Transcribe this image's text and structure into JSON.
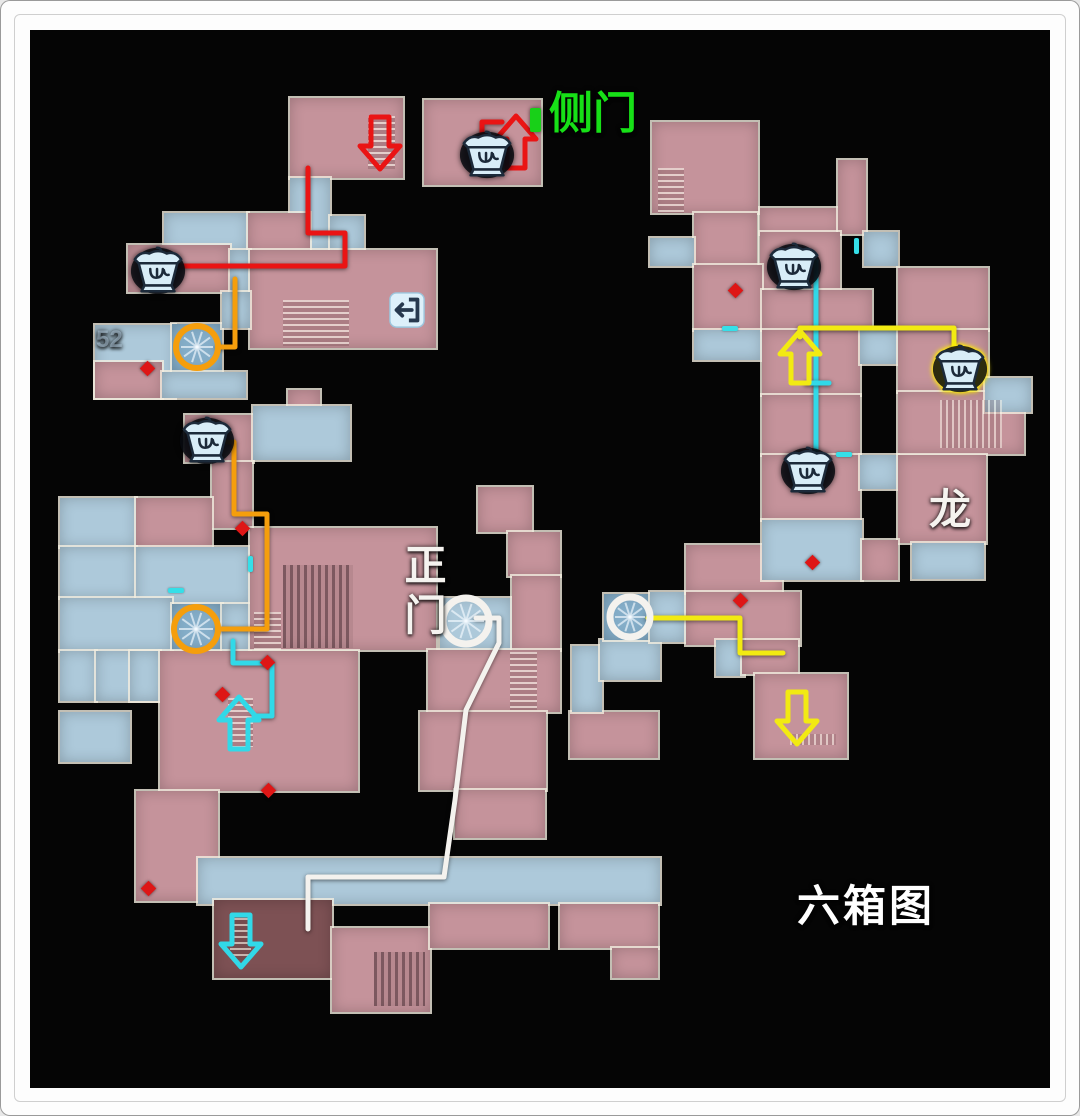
{
  "labels": {
    "side_door": "侧门",
    "main_gate": "正门",
    "dragon": "龙",
    "six_box": "六箱图",
    "room52": "52"
  },
  "palette": {
    "room": {
      "p": "#c5939b",
      "b": "#adc9da",
      "t": "#84adc8",
      "d": "#7d5154"
    },
    "route": {
      "red": "#ea1414",
      "orange": "#f59e0c",
      "cyan": "#31d9e8",
      "yellow": "#f2ea12",
      "white": "#f4f2ee"
    },
    "diamond": "#de1616",
    "tick": "#35dfe8",
    "green_door": "#18d018",
    "label_green": "#17e017",
    "label_white": "#f5f3ef"
  },
  "map": {
    "rooms": [
      [
        290,
        98,
        113,
        80,
        "p"
      ],
      [
        424,
        100,
        117,
        85,
        "p"
      ],
      [
        290,
        178,
        40,
        74,
        "b"
      ],
      [
        330,
        216,
        34,
        36,
        "b"
      ],
      [
        164,
        213,
        84,
        39,
        "b"
      ],
      [
        248,
        213,
        62,
        39,
        "p"
      ],
      [
        128,
        245,
        102,
        47,
        "p"
      ],
      [
        230,
        250,
        20,
        44,
        "b"
      ],
      [
        250,
        250,
        186,
        98,
        "p"
      ],
      [
        95,
        325,
        80,
        73,
        "b"
      ],
      [
        172,
        324,
        50,
        48,
        "t"
      ],
      [
        222,
        292,
        28,
        36,
        "b"
      ],
      [
        95,
        362,
        67,
        36,
        "p"
      ],
      [
        162,
        372,
        84,
        26,
        "b"
      ],
      [
        288,
        390,
        32,
        28,
        "p"
      ],
      [
        185,
        415,
        68,
        47,
        "p"
      ],
      [
        253,
        406,
        97,
        54,
        "b"
      ],
      [
        212,
        462,
        40,
        66,
        "p"
      ],
      [
        60,
        498,
        76,
        49,
        "b"
      ],
      [
        136,
        498,
        76,
        49,
        "p"
      ],
      [
        60,
        547,
        76,
        51,
        "b"
      ],
      [
        136,
        547,
        114,
        58,
        "b"
      ],
      [
        60,
        598,
        112,
        53,
        "b"
      ],
      [
        172,
        604,
        50,
        46,
        "t"
      ],
      [
        60,
        651,
        36,
        50,
        "b"
      ],
      [
        96,
        651,
        64,
        50,
        "b"
      ],
      [
        130,
        651,
        30,
        50,
        "b"
      ],
      [
        222,
        604,
        28,
        47,
        "b"
      ],
      [
        250,
        528,
        186,
        122,
        "p"
      ],
      [
        160,
        651,
        198,
        140,
        "p"
      ],
      [
        60,
        712,
        70,
        50,
        "b"
      ],
      [
        136,
        791,
        82,
        110,
        "p"
      ],
      [
        198,
        858,
        462,
        46,
        "b"
      ],
      [
        214,
        900,
        118,
        78,
        "d"
      ],
      [
        332,
        928,
        98,
        84,
        "p"
      ],
      [
        430,
        904,
        118,
        44,
        "p"
      ],
      [
        560,
        904,
        98,
        44,
        "p"
      ],
      [
        612,
        948,
        46,
        30,
        "p"
      ],
      [
        478,
        487,
        54,
        45,
        "p"
      ],
      [
        508,
        532,
        52,
        44,
        "p"
      ],
      [
        440,
        598,
        72,
        52,
        "b"
      ],
      [
        512,
        576,
        48,
        74,
        "p"
      ],
      [
        428,
        650,
        132,
        62,
        "p"
      ],
      [
        420,
        712,
        126,
        78,
        "p"
      ],
      [
        455,
        790,
        90,
        48,
        "p"
      ],
      [
        570,
        712,
        88,
        46,
        "p"
      ],
      [
        572,
        646,
        30,
        66,
        "b"
      ],
      [
        600,
        640,
        60,
        40,
        "b"
      ],
      [
        604,
        594,
        46,
        46,
        "t"
      ],
      [
        650,
        592,
        36,
        50,
        "b"
      ],
      [
        686,
        545,
        96,
        48,
        "p"
      ],
      [
        686,
        592,
        114,
        53,
        "p"
      ],
      [
        716,
        640,
        28,
        36,
        "b"
      ],
      [
        742,
        640,
        56,
        34,
        "p"
      ],
      [
        755,
        674,
        92,
        84,
        "p"
      ],
      [
        652,
        122,
        106,
        91,
        "p"
      ],
      [
        694,
        213,
        63,
        52,
        "p"
      ],
      [
        650,
        238,
        44,
        28,
        "b"
      ],
      [
        760,
        208,
        80,
        26,
        "p"
      ],
      [
        838,
        160,
        28,
        74,
        "p"
      ],
      [
        760,
        232,
        80,
        58,
        "p"
      ],
      [
        864,
        232,
        34,
        34,
        "b"
      ],
      [
        694,
        265,
        68,
        65,
        "p"
      ],
      [
        694,
        330,
        68,
        30,
        "b"
      ],
      [
        762,
        290,
        110,
        40,
        "p"
      ],
      [
        898,
        268,
        90,
        62,
        "p"
      ],
      [
        762,
        330,
        98,
        65,
        "p"
      ],
      [
        860,
        330,
        38,
        34,
        "b"
      ],
      [
        898,
        330,
        90,
        62,
        "p"
      ],
      [
        898,
        392,
        126,
        62,
        "p"
      ],
      [
        985,
        378,
        46,
        34,
        "b"
      ],
      [
        762,
        395,
        98,
        60,
        "p"
      ],
      [
        762,
        455,
        98,
        65,
        "p"
      ],
      [
        860,
        455,
        38,
        34,
        "b"
      ],
      [
        898,
        455,
        88,
        88,
        "p"
      ],
      [
        912,
        543,
        72,
        36,
        "b"
      ],
      [
        762,
        520,
        100,
        60,
        "b"
      ],
      [
        862,
        540,
        36,
        40,
        "p"
      ]
    ],
    "textures": [
      [
        368,
        116,
        27,
        53,
        "sh"
      ],
      [
        283,
        300,
        66,
        46,
        "sh"
      ],
      [
        658,
        168,
        26,
        45,
        "sh"
      ],
      [
        283,
        565,
        70,
        83,
        "gd"
      ],
      [
        254,
        612,
        27,
        38,
        "sh"
      ],
      [
        228,
        698,
        25,
        49,
        "sh"
      ],
      [
        230,
        918,
        21,
        42,
        "sh"
      ],
      [
        374,
        952,
        51,
        54,
        "gd"
      ],
      [
        510,
        652,
        27,
        58,
        "sh"
      ],
      [
        940,
        400,
        62,
        48,
        "gv"
      ],
      [
        790,
        734,
        46,
        11,
        "gv"
      ]
    ],
    "routes": [
      {
        "name": "red-route-main",
        "c": "red",
        "w": 5,
        "pts": [
          [
            308,
            168
          ],
          [
            308,
            233
          ],
          [
            345,
            233
          ],
          [
            345,
            266
          ],
          [
            163,
            266
          ]
        ]
      },
      {
        "name": "red-route-side-door",
        "c": "red",
        "w": 5,
        "pts": [
          [
            482,
            167
          ],
          [
            482,
            122
          ],
          [
            502,
            122
          ]
        ]
      },
      {
        "name": "orange-route-upper",
        "c": "orange",
        "w": 5,
        "pts": [
          [
            235,
            279
          ],
          [
            235,
            347
          ],
          [
            218,
            347
          ]
        ]
      },
      {
        "name": "orange-route-lower",
        "c": "orange",
        "w": 5,
        "pts": [
          [
            227,
            442
          ],
          [
            234,
            442
          ],
          [
            234,
            514
          ],
          [
            267,
            514
          ],
          [
            267,
            629
          ],
          [
            218,
            629
          ]
        ]
      },
      {
        "name": "cyan-route-left",
        "c": "cyan",
        "w": 5,
        "pts": [
          [
            233,
            641
          ],
          [
            233,
            663
          ],
          [
            272,
            663
          ],
          [
            272,
            716
          ],
          [
            254,
            716
          ]
        ]
      },
      {
        "name": "cyan-route-right",
        "c": "cyan",
        "w": 5,
        "pts": [
          [
            810,
            261
          ],
          [
            816,
            261
          ],
          [
            816,
            468
          ]
        ]
      },
      {
        "name": "cyan-route-cross-tick",
        "c": "cyan",
        "w": 5,
        "pts": [
          [
            806,
            383
          ],
          [
            829,
            383
          ]
        ]
      },
      {
        "name": "yellow-route-upper",
        "c": "yellow",
        "w": 5,
        "pts": [
          [
            800,
            337
          ],
          [
            800,
            328
          ],
          [
            954,
            328
          ],
          [
            954,
            351
          ]
        ]
      },
      {
        "name": "yellow-route-lower",
        "c": "yellow",
        "w": 5,
        "pts": [
          [
            648,
            618
          ],
          [
            740,
            618
          ],
          [
            740,
            653
          ],
          [
            783,
            653
          ]
        ]
      },
      {
        "name": "white-route-main-gate",
        "c": "white",
        "w": 5,
        "pts": [
          [
            476,
            618
          ],
          [
            499,
            618
          ],
          [
            499,
            643
          ],
          [
            466,
            710
          ],
          [
            455,
            800
          ],
          [
            444,
            877
          ],
          [
            308,
            877
          ],
          [
            308,
            929
          ]
        ]
      }
    ],
    "arrows": [
      {
        "name": "red-arrow-down-stairs",
        "x": 380,
        "y": 143,
        "dir": "down",
        "c": "red"
      },
      {
        "name": "red-arrow-up-side-door",
        "x": 516,
        "y": 142,
        "dir": "up",
        "c": "red"
      },
      {
        "name": "yellow-arrow-up",
        "x": 800,
        "y": 357,
        "dir": "up",
        "c": "yellow"
      },
      {
        "name": "yellow-arrow-down",
        "x": 797,
        "y": 718,
        "dir": "down",
        "c": "yellow"
      },
      {
        "name": "cyan-arrow-up",
        "x": 239,
        "y": 723,
        "dir": "up",
        "c": "cyan"
      },
      {
        "name": "cyan-arrow-down-stairs",
        "x": 241,
        "y": 941,
        "dir": "down",
        "c": "cyan"
      }
    ],
    "circles": [
      {
        "name": "orange-circle-upper",
        "x": 197,
        "y": 347,
        "r": 21,
        "c": "orange"
      },
      {
        "name": "orange-circle-lower",
        "x": 196,
        "y": 629,
        "r": 22,
        "c": "orange"
      },
      {
        "name": "white-circle-main-gate",
        "x": 466,
        "y": 621,
        "r": 23,
        "c": "white"
      },
      {
        "name": "white-circle-right",
        "x": 630,
        "y": 617,
        "r": 20,
        "c": "white"
      }
    ],
    "chests": [
      {
        "x": 487,
        "y": 153,
        "v": "blue"
      },
      {
        "x": 158,
        "y": 269,
        "v": "blue"
      },
      {
        "x": 207,
        "y": 439,
        "v": "blue"
      },
      {
        "x": 794,
        "y": 265,
        "v": "blue"
      },
      {
        "x": 808,
        "y": 469,
        "v": "blue"
      },
      {
        "x": 960,
        "y": 367,
        "v": "yellow"
      }
    ],
    "diamonds": [
      [
        242,
        528
      ],
      [
        267,
        662
      ],
      [
        222,
        694
      ],
      [
        268,
        790
      ],
      [
        148,
        888
      ],
      [
        735,
        290
      ],
      [
        740,
        600
      ],
      [
        812,
        562
      ],
      [
        147,
        368
      ]
    ],
    "ticks": [
      [
        248,
        556,
        5,
        16
      ],
      [
        168,
        588,
        16,
        5
      ],
      [
        722,
        326,
        16,
        5
      ],
      [
        854,
        238,
        5,
        16
      ],
      [
        836,
        452,
        16,
        5
      ]
    ],
    "exit_icon": {
      "x": 388,
      "y": 291,
      "s": 38
    },
    "green_door": {
      "x": 530,
      "y": 108,
      "w": 11,
      "h": 24
    }
  }
}
